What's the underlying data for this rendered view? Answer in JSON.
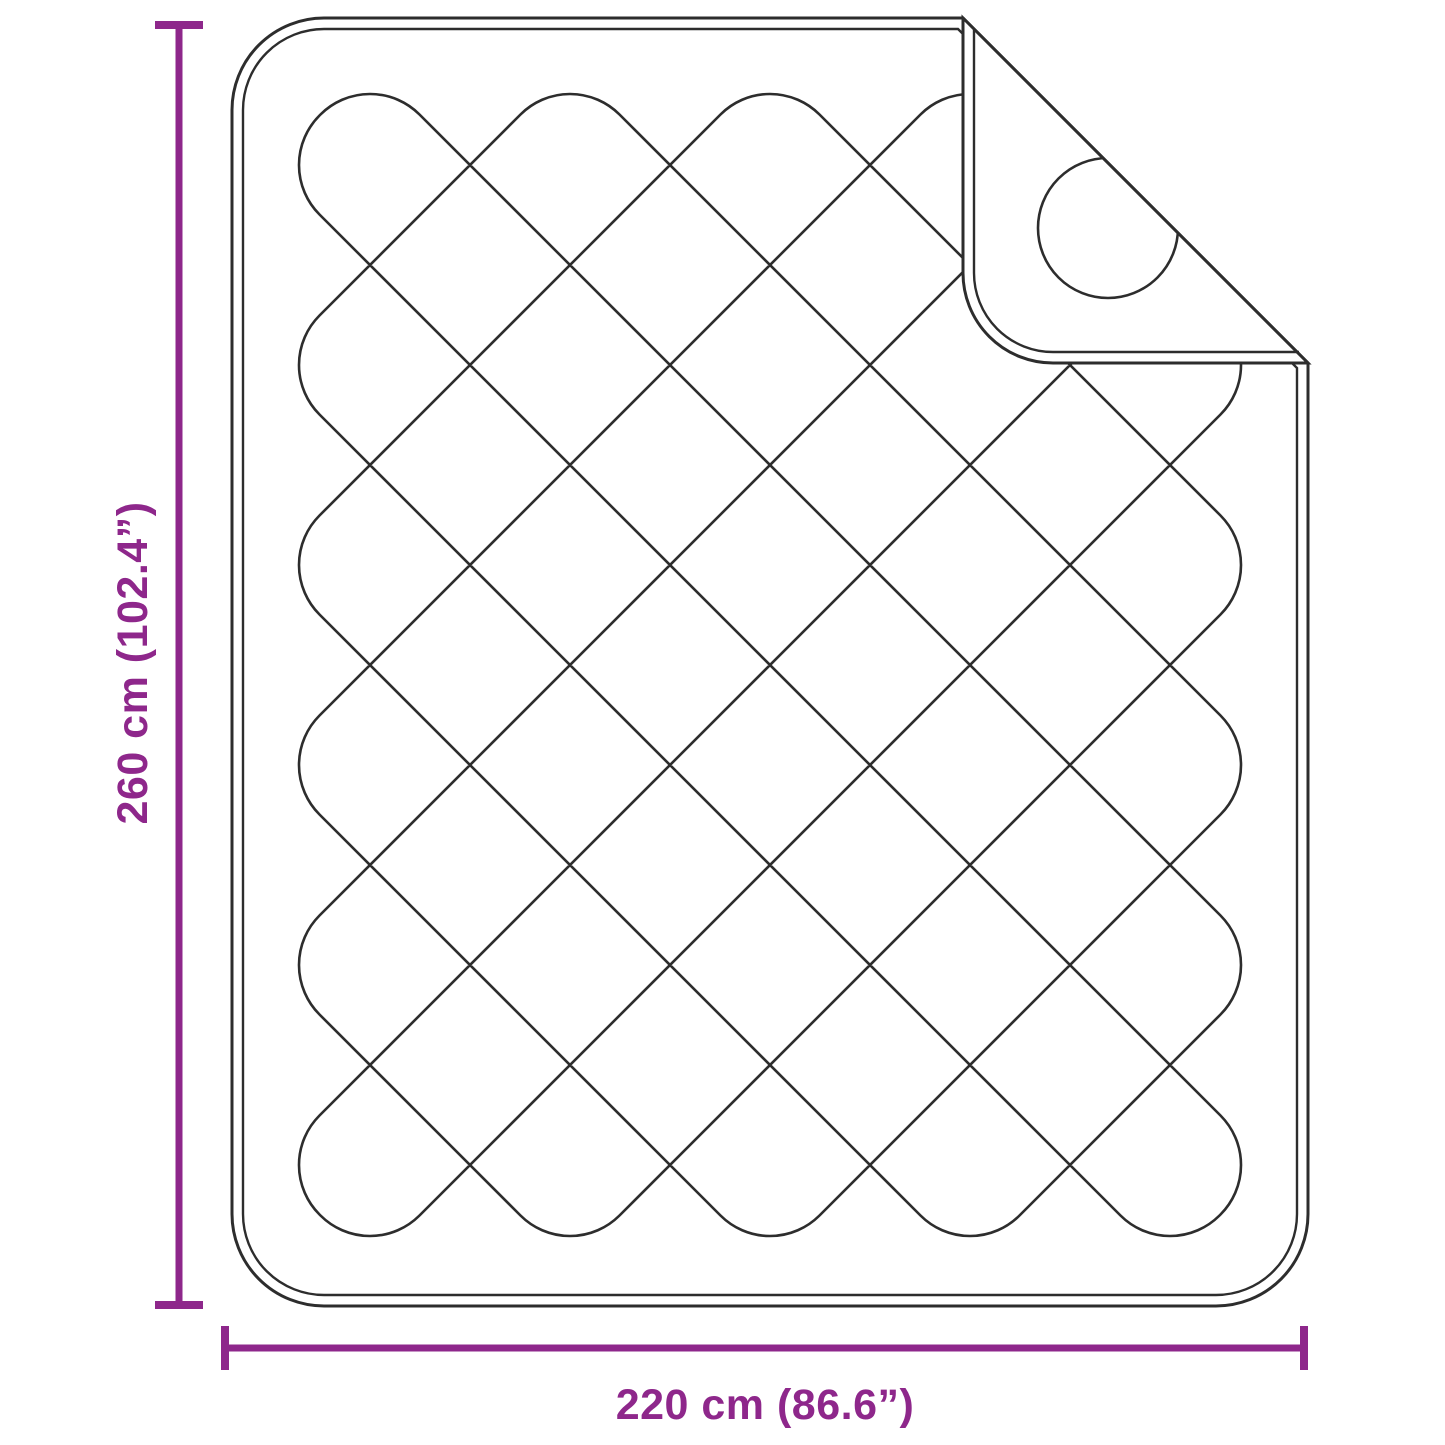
{
  "diagram": {
    "height_dimension": {
      "label": "260 cm (102.4”)",
      "value_cm": "260",
      "value_inches": "102.4"
    },
    "width_dimension": {
      "label": "220 cm (86.6”)",
      "value_cm": "220",
      "value_inches": "86.6"
    }
  },
  "colors": {
    "accent": "#8e278b",
    "line": "#2d2d2d",
    "background": "#ffffff"
  }
}
